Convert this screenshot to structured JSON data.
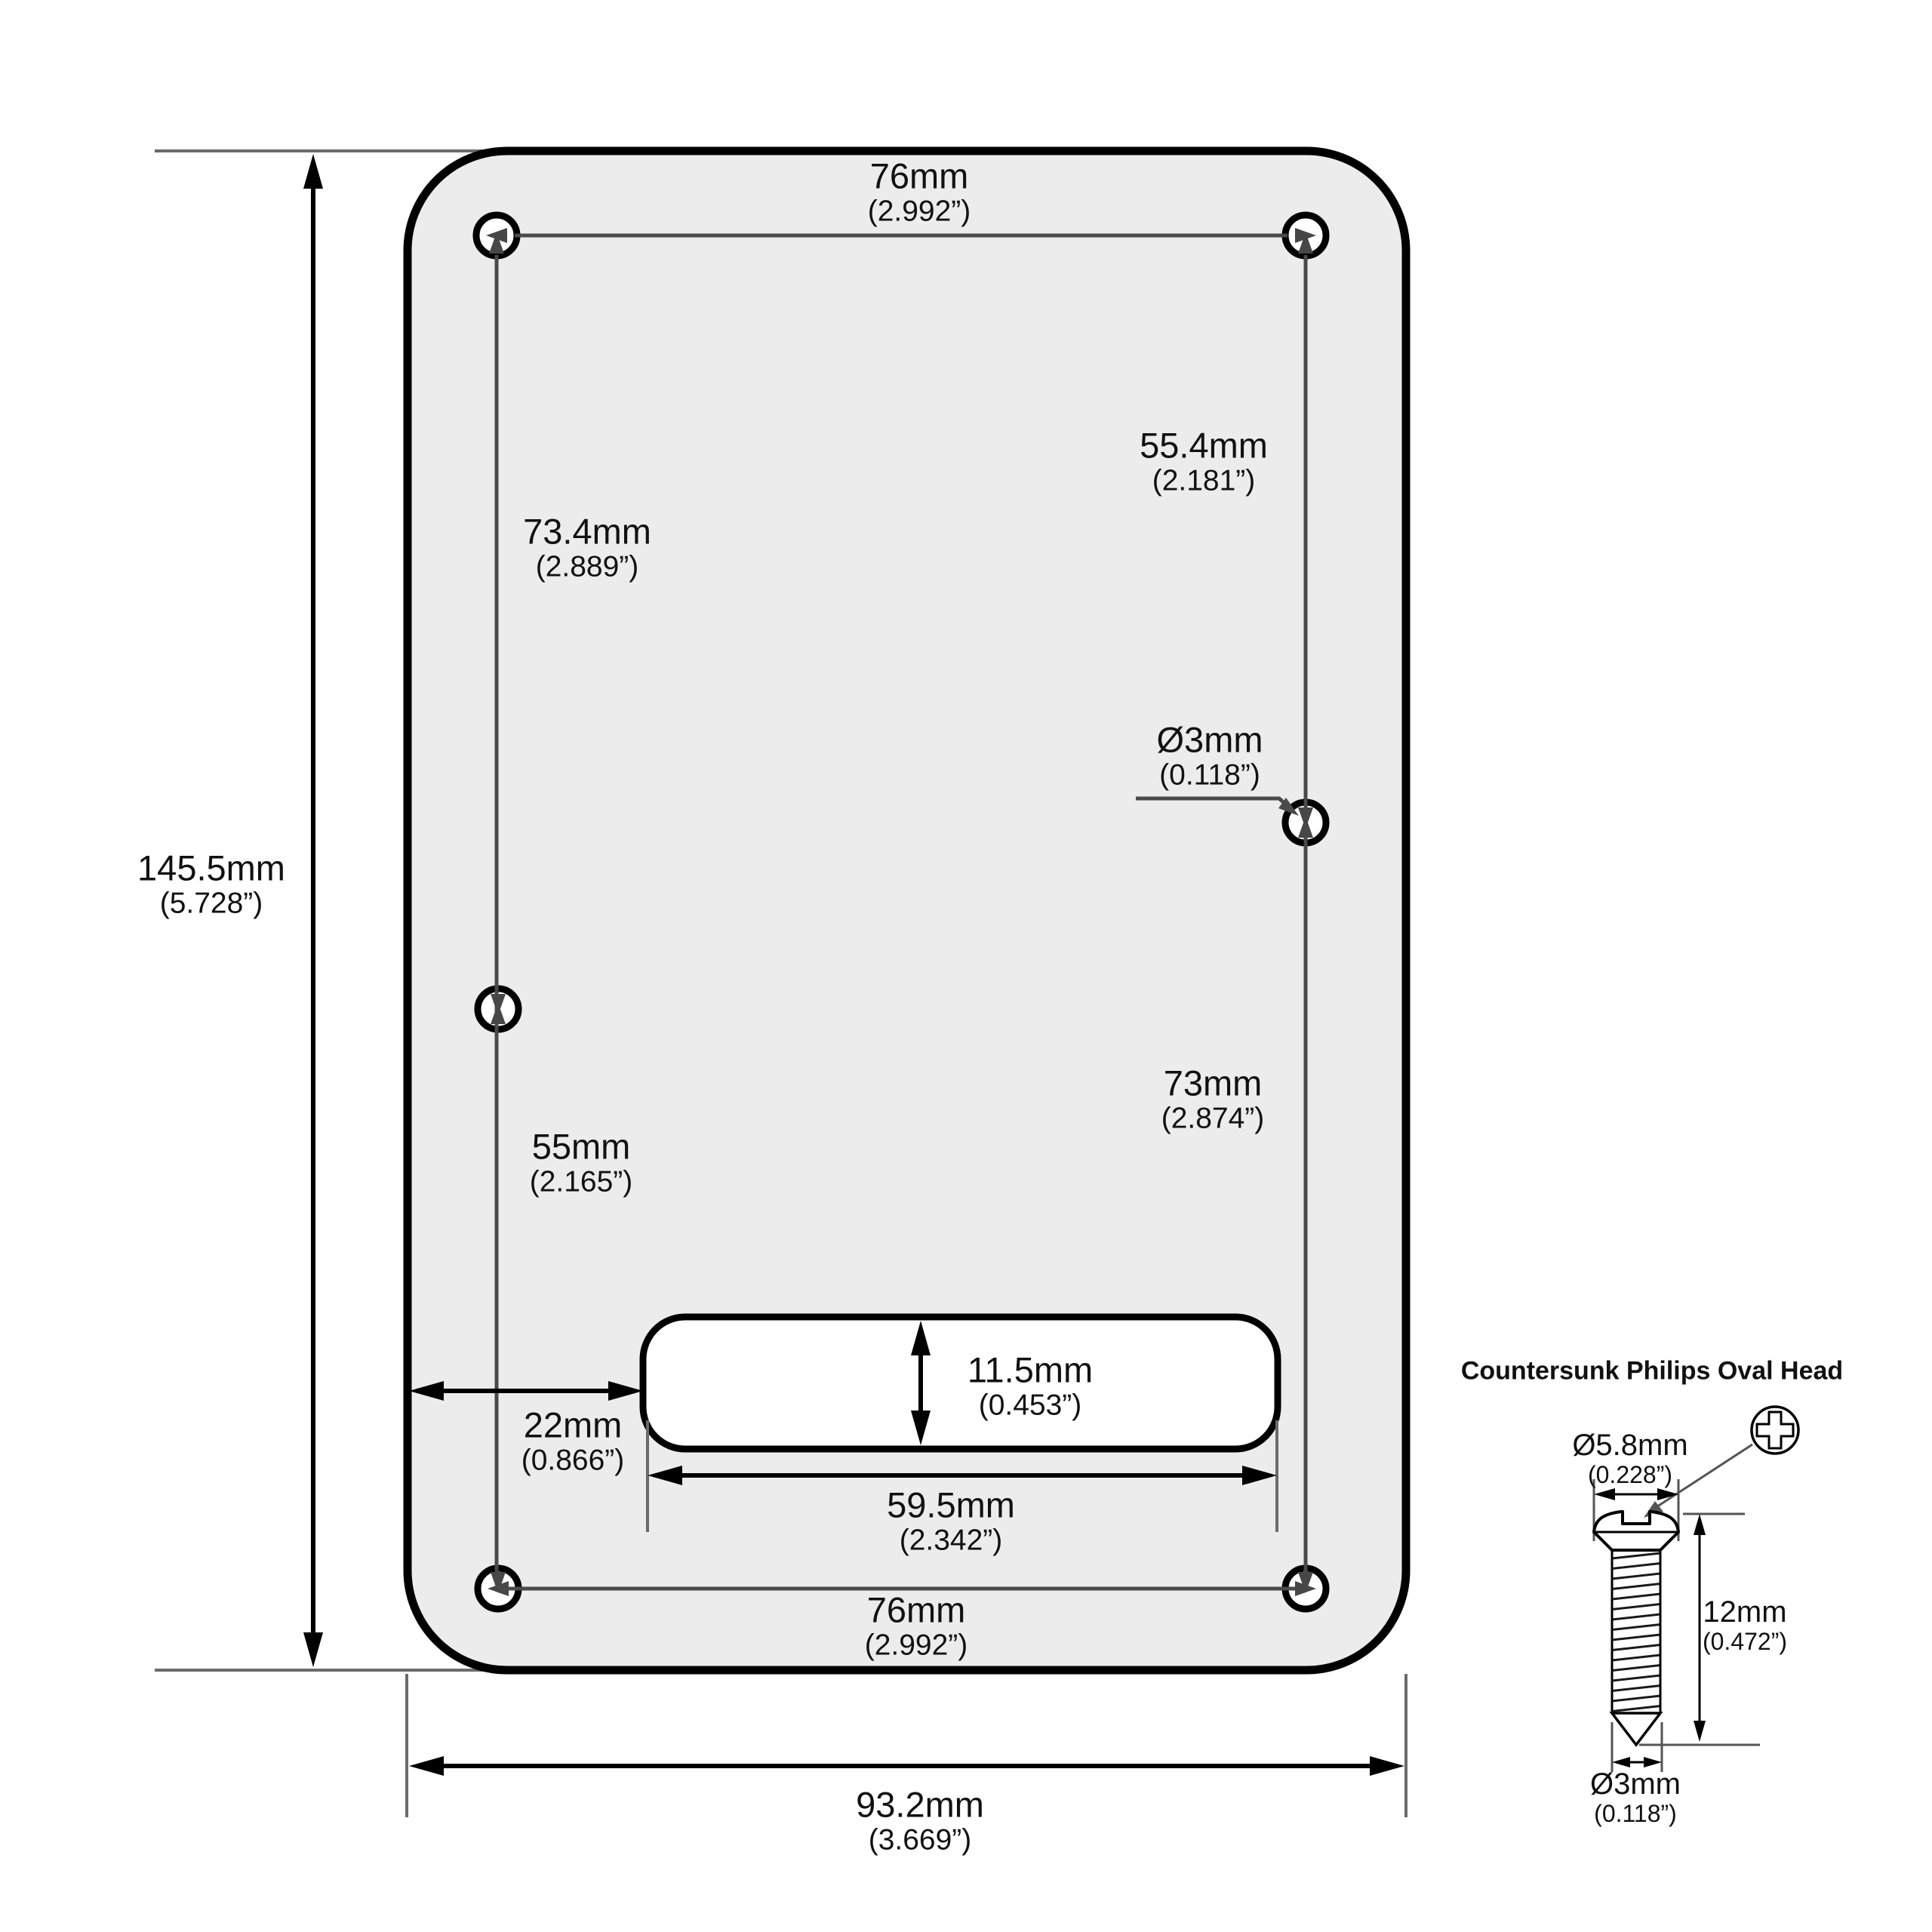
{
  "colors": {
    "plate_fill": "#ececec",
    "outline": "#000000",
    "dim_line": "#4a4a4a",
    "guide_line": "#6b6b6b",
    "text": "#111111"
  },
  "dimensions": {
    "top_width": {
      "mm": "76mm",
      "inch": "(2.992”)"
    },
    "upper_right": {
      "mm": "55.4mm",
      "inch": "(2.181”)"
    },
    "upper_left": {
      "mm": "73.4mm",
      "inch": "(2.889”)"
    },
    "hole_diameter": {
      "mm": "Ø3mm",
      "inch": "(0.118”)"
    },
    "overall_height": {
      "mm": "145.5mm",
      "inch": "(5.728”)"
    },
    "lower_right": {
      "mm": "73mm",
      "inch": "(2.874”)"
    },
    "lower_left": {
      "mm": "55mm",
      "inch": "(2.165”)"
    },
    "cutout_height": {
      "mm": "11.5mm",
      "inch": "(0.453”)"
    },
    "cutout_offset": {
      "mm": "22mm",
      "inch": "(0.866”)"
    },
    "cutout_width": {
      "mm": "59.5mm",
      "inch": "(2.342”)"
    },
    "bottom_width": {
      "mm": "76mm",
      "inch": "(2.992”)"
    },
    "overall_width": {
      "mm": "93.2mm",
      "inch": "(3.669”)"
    }
  },
  "screw": {
    "title": "Countersunk Philips Oval Head",
    "head_diameter": {
      "mm": "Ø5.8mm",
      "inch": "(0.228”)"
    },
    "length": {
      "mm": "12mm",
      "inch": "(0.472”)"
    },
    "thread_diameter": {
      "mm": "Ø3mm",
      "inch": "(0.118”)"
    }
  }
}
